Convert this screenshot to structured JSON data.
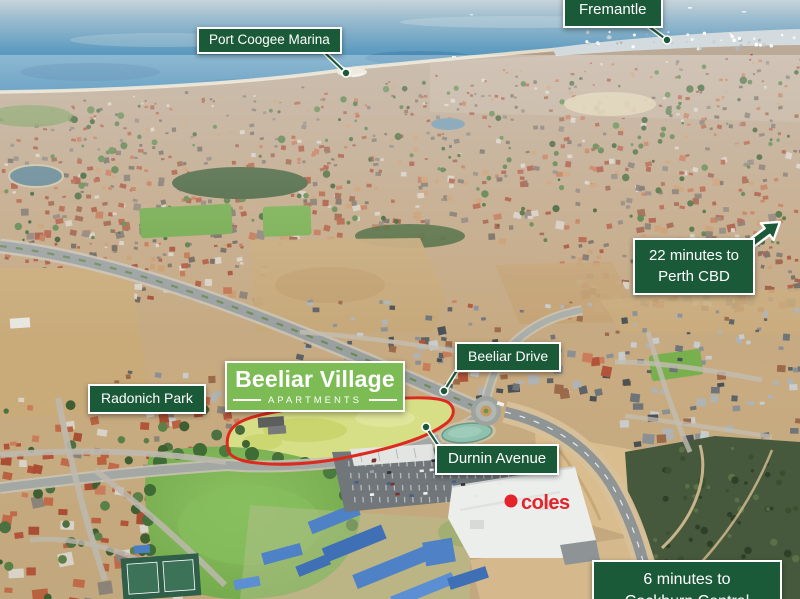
{
  "page": {
    "title": "Beeliar Village Apartments aerial location map"
  },
  "labels": {
    "fremantle": {
      "text": "Fremantle"
    },
    "port_coogee_marina": {
      "text": "Port Coogee Marina"
    },
    "perth_cbd": {
      "line1": "22 minutes to",
      "line2": "Perth CBD"
    },
    "beeliar_drive": {
      "text": "Beeliar Drive"
    },
    "radonich_park": {
      "text": "Radonich Park"
    },
    "durnin_avenue": {
      "text": "Durnin Avenue"
    },
    "cockburn_central": {
      "line1": "6 minutes to",
      "line2": "Cockburn Central"
    }
  },
  "brand": {
    "title": "Beeliar Village",
    "subtitle": "APARTMENTS"
  },
  "photo": {
    "coles_sign": "coles"
  },
  "colors": {
    "label_bg": "#1b5a38",
    "label_text": "#ffffff",
    "label_border": "#ffffff",
    "brand_bg": "#7dbc55",
    "site_outline": "#dc2a1e",
    "coles_red": "#e4232b"
  }
}
